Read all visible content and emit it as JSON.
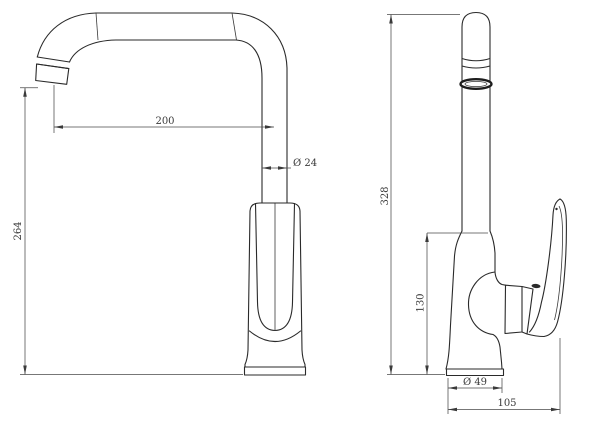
{
  "colors": {
    "background": "#ffffff",
    "line": "#2a2a2a",
    "dimension_line": "#4a4a4a",
    "text": "#3a3a3a"
  },
  "dimensions": {
    "front": {
      "spout_reach": "200",
      "spout_tube_diameter": "Ø 24",
      "spout_outlet_height": "264"
    },
    "side": {
      "overall_height": "328",
      "body_top_height": "130",
      "base_diameter": "Ø 49",
      "overall_depth": "105"
    }
  }
}
